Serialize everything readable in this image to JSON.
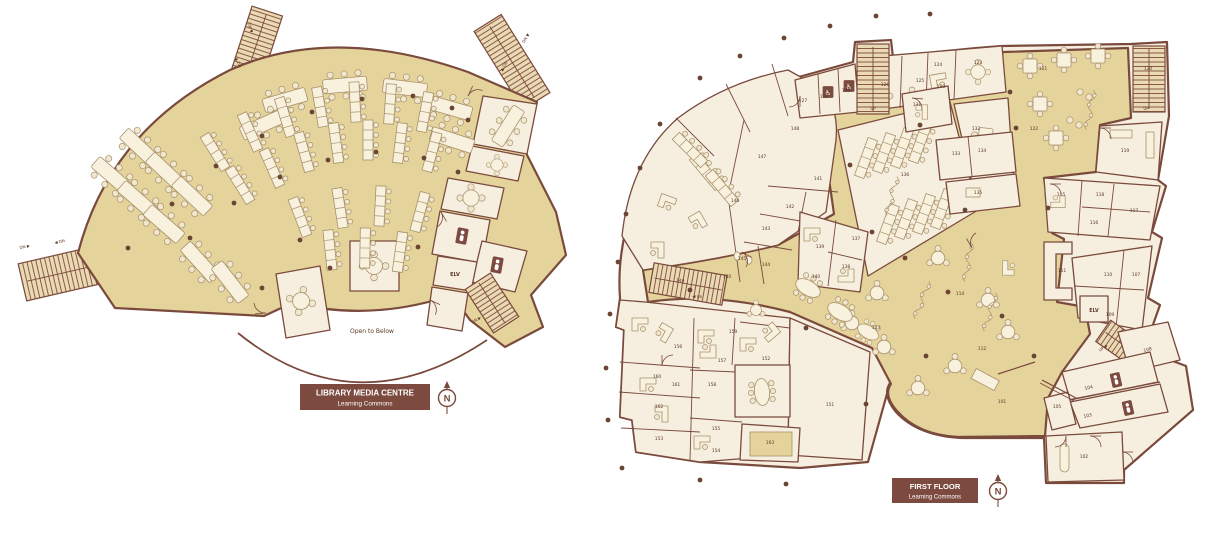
{
  "colors": {
    "wall": "#7a4a3c",
    "open_floor": "#e4d39b",
    "room_fill": "#f6efe0",
    "stair_fill": "#ead9b5",
    "furniture_line": "#a8916c",
    "column": "#6b4433",
    "label": "#5d3a28",
    "title_box": "#7c4a3e",
    "title_text": "#ffffff"
  },
  "compass": {
    "label": "N"
  },
  "left_plan": {
    "title": "LIBRARY MEDIA CENTRE",
    "subtitle": "Learning Commons",
    "labels": [
      {
        "text": "DN ▶",
        "x": 25,
        "y": 248,
        "rot": -13,
        "s": 4,
        "name": "stair-label"
      },
      {
        "text": "◀ DN",
        "x": 60,
        "y": 243,
        "rot": -13,
        "s": 4,
        "name": "stair-label"
      },
      {
        "text": "DN ▼",
        "x": 249,
        "y": 28,
        "rot": 72,
        "s": 4,
        "name": "stair-label"
      },
      {
        "text": "▲ DN",
        "x": 237,
        "y": 63,
        "rot": 72,
        "s": 4,
        "name": "stair-label"
      },
      {
        "text": "DN ▼",
        "x": 527,
        "y": 39,
        "rot": -58,
        "s": 4,
        "name": "stair-label"
      },
      {
        "text": "▲ DN",
        "x": 505,
        "y": 67,
        "rot": -58,
        "s": 4,
        "name": "stair-label"
      },
      {
        "text": "DN ▶",
        "x": 477,
        "y": 321,
        "rot": -33,
        "s": 4,
        "name": "stair-label"
      },
      {
        "text": "ELV",
        "x": 455,
        "y": 276,
        "s": 5,
        "b": true,
        "name": "elevator-label"
      },
      {
        "text": "Open to Below",
        "x": 372,
        "y": 333,
        "s": 6,
        "name": "open-to-below-label"
      }
    ]
  },
  "right_plan": {
    "title": "FIRST FLOOR",
    "subtitle": "Learning Commons",
    "labels": [
      {
        "text": "101",
        "x": 1002,
        "y": 403
      },
      {
        "text": "102",
        "x": 1084,
        "y": 458
      },
      {
        "text": "103",
        "x": 1088,
        "y": 417,
        "rot": -13
      },
      {
        "text": "104",
        "x": 1089,
        "y": 389,
        "rot": -13
      },
      {
        "text": "105",
        "x": 1057,
        "y": 408
      },
      {
        "text": "107",
        "x": 1136,
        "y": 276
      },
      {
        "text": "108",
        "x": 1148,
        "y": 351,
        "rot": -15
      },
      {
        "text": "109",
        "x": 1110,
        "y": 316
      },
      {
        "text": "110",
        "x": 1108,
        "y": 276
      },
      {
        "text": "111",
        "x": 1062,
        "y": 272
      },
      {
        "text": "112",
        "x": 982,
        "y": 350
      },
      {
        "text": "113",
        "x": 876,
        "y": 329
      },
      {
        "text": "114",
        "x": 960,
        "y": 295
      },
      {
        "text": "115",
        "x": 1061,
        "y": 196
      },
      {
        "text": "116",
        "x": 1094,
        "y": 224
      },
      {
        "text": "117",
        "x": 1134,
        "y": 212
      },
      {
        "text": "118",
        "x": 1100,
        "y": 196
      },
      {
        "text": "119",
        "x": 1125,
        "y": 152
      },
      {
        "text": "120",
        "x": 1148,
        "y": 70
      },
      {
        "text": "121",
        "x": 1043,
        "y": 70
      },
      {
        "text": "122",
        "x": 1034,
        "y": 130
      },
      {
        "text": "123",
        "x": 978,
        "y": 64
      },
      {
        "text": "124",
        "x": 938,
        "y": 66
      },
      {
        "text": "125",
        "x": 920,
        "y": 82
      },
      {
        "text": "126",
        "x": 885,
        "y": 86
      },
      {
        "text": "127",
        "x": 803,
        "y": 102
      },
      {
        "text": "128",
        "x": 824,
        "y": 98
      },
      {
        "text": "129",
        "x": 846,
        "y": 92
      },
      {
        "text": "130",
        "x": 941,
        "y": 88
      },
      {
        "text": "131",
        "x": 917,
        "y": 106
      },
      {
        "text": "132",
        "x": 976,
        "y": 130
      },
      {
        "text": "133",
        "x": 956,
        "y": 155
      },
      {
        "text": "134",
        "x": 982,
        "y": 152
      },
      {
        "text": "135",
        "x": 978,
        "y": 194
      },
      {
        "text": "136",
        "x": 905,
        "y": 176
      },
      {
        "text": "137",
        "x": 856,
        "y": 240
      },
      {
        "text": "138",
        "x": 846,
        "y": 268
      },
      {
        "text": "139",
        "x": 820,
        "y": 248
      },
      {
        "text": "140",
        "x": 816,
        "y": 278
      },
      {
        "text": "141",
        "x": 818,
        "y": 180
      },
      {
        "text": "142",
        "x": 790,
        "y": 208
      },
      {
        "text": "143",
        "x": 766,
        "y": 230
      },
      {
        "text": "144",
        "x": 766,
        "y": 266
      },
      {
        "text": "145",
        "x": 742,
        "y": 260
      },
      {
        "text": "146",
        "x": 735,
        "y": 202
      },
      {
        "text": "147",
        "x": 762,
        "y": 158
      },
      {
        "text": "148",
        "x": 795,
        "y": 130
      },
      {
        "text": "149",
        "x": 680,
        "y": 282,
        "rot": 8
      },
      {
        "text": "150",
        "x": 727,
        "y": 278
      },
      {
        "text": "151",
        "x": 830,
        "y": 406
      },
      {
        "text": "152",
        "x": 766,
        "y": 360
      },
      {
        "text": "153",
        "x": 659,
        "y": 440
      },
      {
        "text": "154",
        "x": 716,
        "y": 452
      },
      {
        "text": "155",
        "x": 716,
        "y": 430
      },
      {
        "text": "156",
        "x": 678,
        "y": 348
      },
      {
        "text": "157",
        "x": 722,
        "y": 362
      },
      {
        "text": "158",
        "x": 712,
        "y": 386
      },
      {
        "text": "159",
        "x": 733,
        "y": 333
      },
      {
        "text": "160",
        "x": 657,
        "y": 378
      },
      {
        "text": "161",
        "x": 676,
        "y": 386
      },
      {
        "text": "162",
        "x": 659,
        "y": 408
      },
      {
        "text": "163",
        "x": 770,
        "y": 444
      },
      {
        "text": "ELV",
        "x": 1094,
        "y": 312,
        "s": 4.8,
        "b": true,
        "name": "elevator-label"
      },
      {
        "text": "UP",
        "x": 873,
        "y": 110,
        "s": 4,
        "name": "stair-label"
      },
      {
        "text": "UP",
        "x": 1146,
        "y": 110,
        "s": 4,
        "name": "stair-label"
      },
      {
        "text": "◀ UP",
        "x": 697,
        "y": 298,
        "rot": 8,
        "s": 4,
        "name": "stair-label"
      },
      {
        "text": "UP ▶",
        "x": 1104,
        "y": 349,
        "rot": -35,
        "s": 4,
        "name": "stair-label"
      }
    ]
  }
}
